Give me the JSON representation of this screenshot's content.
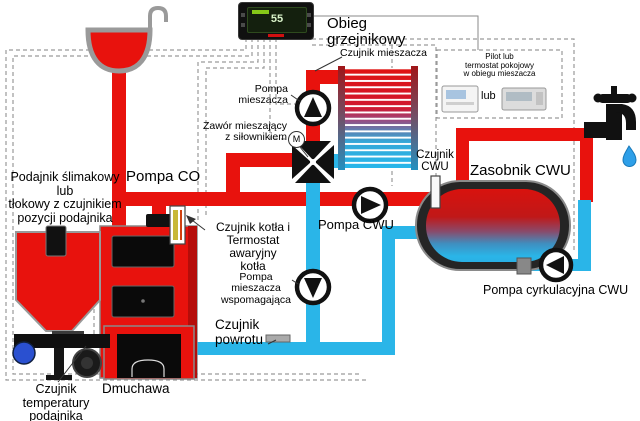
{
  "colors": {
    "hot": "#e8120d",
    "cold": "#2ab5e8",
    "wire": "#9a9a9a",
    "equipment": "#111111"
  },
  "controller": {
    "display_temp": "55"
  },
  "labels": {
    "heating_circuit": "Obieg grzejnikowy",
    "mixer_sensor": "Czujnik mieszacza",
    "thermostat_title": "Pilot lub\ntermostat pokojowy\nw obiegu mieszacza",
    "or": "lub",
    "mixer_pump": "Pompa\nmieszacza",
    "mixing_valve": "Zawór mieszający\nz siłownikiem",
    "m": "M",
    "co_pump": "Pompa CO",
    "feeder": "Podajnik ślimakowy\nlub\ntłokowy z czujnikiem\npozycji podajnika",
    "boiler_sensor": "Czujnik kotła i\nTermostat awaryjny\nkotła",
    "cwu_sensor": "Czujnik\nCWU",
    "tank": "Zasobnik CWU",
    "cwu_pump": "Pompa CWU",
    "support_pump": "Pompa\nmieszacza\nwspomagająca",
    "return_sensor": "Czujnik\npowrotu",
    "feeder_temp_sensor": "Czujnik\ntemperatury\npodajnika",
    "blower": "Dmuchawa",
    "circulation_pump": "Pompa cyrkulacyjna CWU"
  }
}
